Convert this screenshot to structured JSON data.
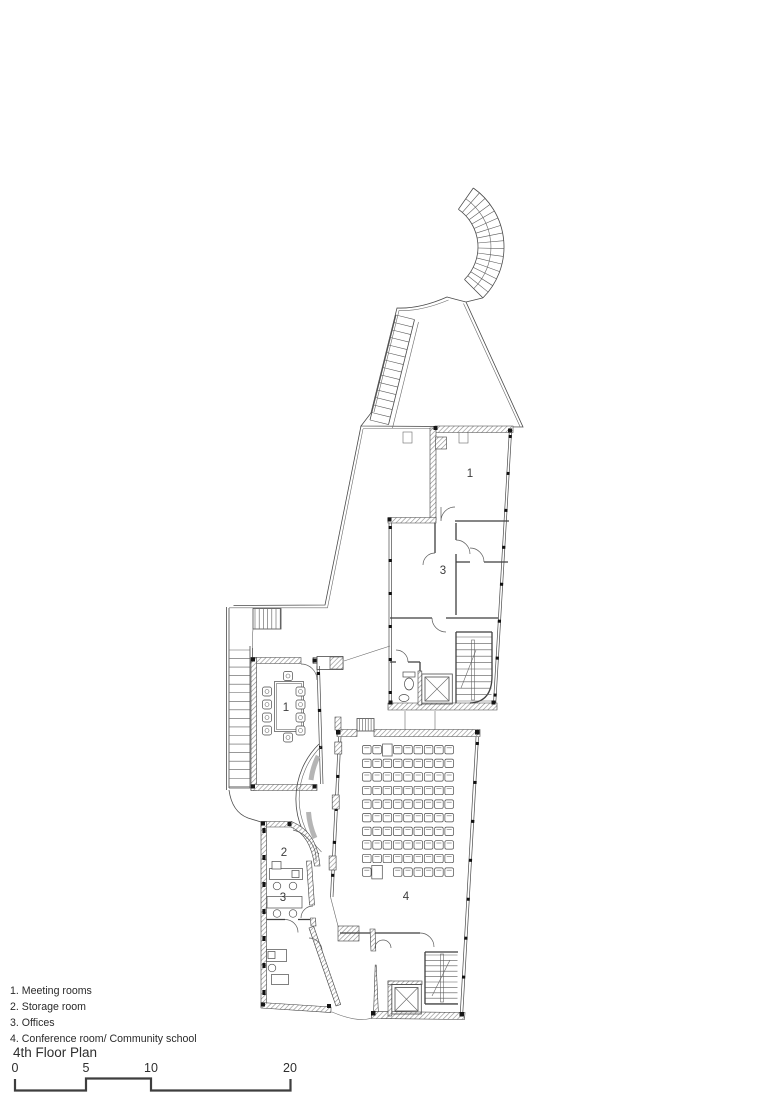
{
  "title": "4th Floor Plan",
  "legend": {
    "items": [
      "1. Meeting rooms",
      "2. Storage room",
      "3. Offices",
      "4. Conference room/ Community school"
    ]
  },
  "rooms": {
    "upper_meeting": {
      "label": "1"
    },
    "upper_offices": {
      "label": "3"
    },
    "west_meeting": {
      "label": "1"
    },
    "storage": {
      "label": "2"
    },
    "offices": {
      "label": "3"
    },
    "conference": {
      "label": "4"
    }
  },
  "scale_bar": {
    "labels": [
      "0",
      "5",
      "10",
      "20"
    ]
  },
  "conference_seating": {
    "rows": 10,
    "seats_per_row": 9
  },
  "meeting_table_seats": 10,
  "colors": {
    "line": "#3f3f3f",
    "wall_hatch": "#8a8a8a",
    "background": "#ffffff"
  }
}
